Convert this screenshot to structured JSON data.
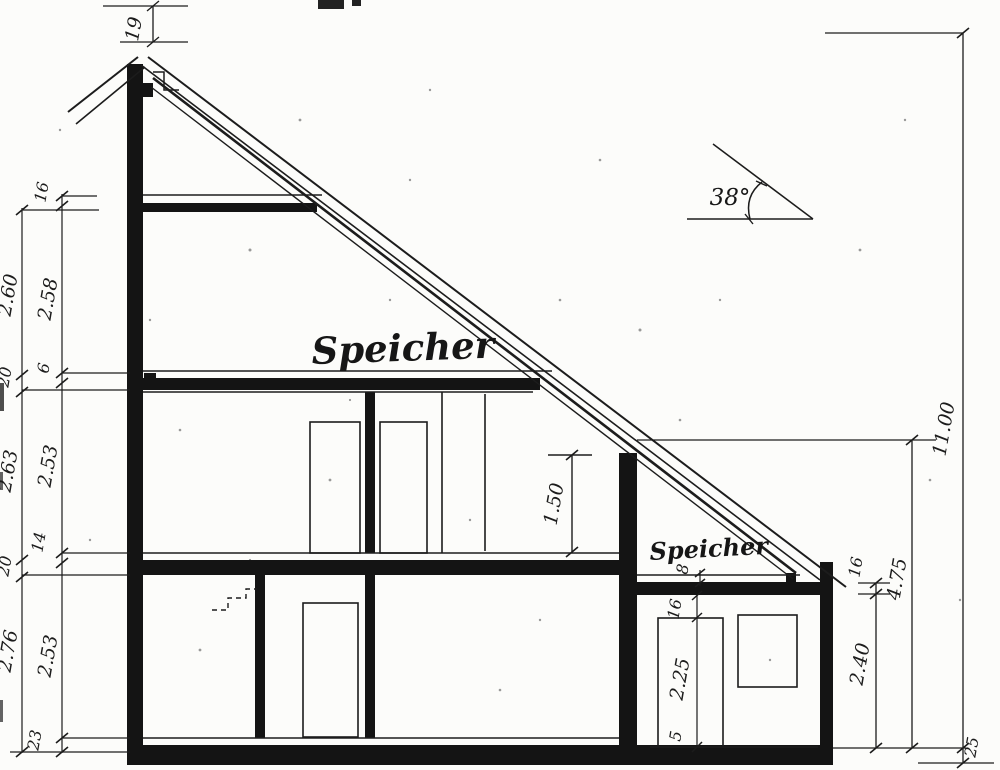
{
  "drawing": {
    "labels": {
      "room_upper_attic": "Speicher",
      "room_annex_attic": "Speicher",
      "roof_angle": "38°"
    },
    "dimensions": {
      "ridge_offset": "19",
      "left_outer_chain": [
        "2.60",
        "20",
        "2.63",
        "20",
        "2.76"
      ],
      "left_inner_chain": [
        "16",
        "2.58",
        "6",
        "2.53",
        "14",
        "2.53",
        "23"
      ],
      "knee_wall_height": "1.50",
      "total_height": "11.00",
      "annex_height": "4.75",
      "annex_room_height": "2.40",
      "annex_slab_thickness": "16",
      "plinth": "25",
      "annex_plate": "8",
      "annex_lintel": "16",
      "annex_door_height": "2.25",
      "annex_sill": "5"
    },
    "colors": {
      "ink": "#1c1c1c",
      "paper": "#fcfcfa"
    }
  }
}
